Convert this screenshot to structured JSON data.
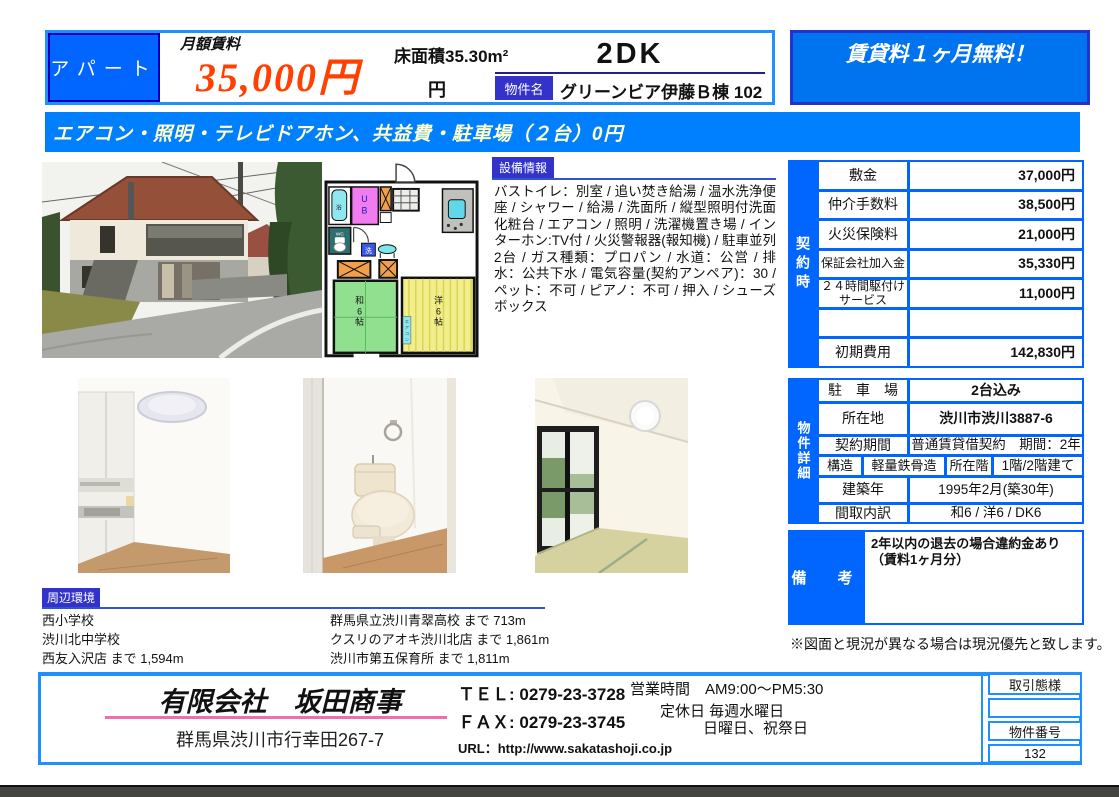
{
  "colors": {
    "primary_blue": "#0080FF",
    "table_blue": "#0066FF",
    "label_indigo": "#3333CC",
    "campaign_blue": "#0073EE",
    "campaign_border": "#2233CC",
    "rent_orange": "#FF4000",
    "banner_text_yellow": "#FFFFCC",
    "pink_underline": "#F06EA9"
  },
  "header": {
    "property_type": "アパート",
    "rent_label": "月額賃料",
    "rent_value": "35,000円",
    "floor_area": "床面積35.30m²",
    "floor_unit": "円",
    "layout": "2DK",
    "property_name_label": "物件名",
    "property_name": "グリーンビア伊藤Ｂ棟 102",
    "campaign": "賃貸料１ヶ月無料！"
  },
  "banner": "エアコン・照明・テレビドアホン、共益費・駐車場（２台）0円",
  "equipment": {
    "label": "設備情報",
    "text": "バストイレ：別室 / 追い焚き給湯 / 温水洗浄便座 / シャワー / 給湯 / 洗面所 / 縦型照明付洗面化粧台 / エアコン / 照明 / 洗濯機置き場 / インターホン:TV付 / 火災警報器(報知機) / 駐車並列2台 / ガス種類：プロパン / 水道：公営 / 排水：公共下水 / 電気容量(契約アンペア)：30 / ペット：不可 / ピアノ：不可 / 押入 / シューズボックス"
  },
  "contract": {
    "label": "契約時",
    "rows": [
      {
        "label": "敷金",
        "value": "37,000円"
      },
      {
        "label": "仲介手数料",
        "value": "38,500円"
      },
      {
        "label": "火災保険料",
        "value": "21,000円"
      },
      {
        "label": "保証会社加入金",
        "value": "35,330円"
      },
      {
        "label": "２４時間駆付けサービス",
        "value": "11,000円"
      },
      {
        "label": "",
        "value": ""
      },
      {
        "label": "初期費用",
        "value": "142,830円"
      }
    ]
  },
  "details": {
    "label": "物件詳細",
    "parking_label": "駐　車　場",
    "parking": "2台込み",
    "location_label": "所在地",
    "location": "渋川市渋川3887-6",
    "period_label": "契約期間",
    "period": "普通賃貸借契約　期間：2年",
    "structure_label": "構造",
    "structure": "軽量鉄骨造",
    "floor_label": "所在階",
    "floor": "1階/2階建て",
    "built_label": "建築年",
    "built": "1995年2月(築30年)",
    "madori_label": "間取内訳",
    "madori": "和6 / 洋6 / DK6"
  },
  "remarks": {
    "label": "備　考",
    "line1": "2年以内の退去の場合違約金あり",
    "line2": "（賃料1ヶ月分）"
  },
  "note": "※図面と現況が異なる場合は現況優先と致します。",
  "environment": {
    "label": "周辺環境",
    "left": [
      "西小学校",
      "渋川北中学校",
      "西友入沢店 まで 1,594m"
    ],
    "right": [
      "群馬県立渋川青翠高校 まで 713m",
      "クスリのアオキ渋川北店 まで 1,861m",
      "渋川市第五保育所 まで 1,811m"
    ]
  },
  "footer": {
    "company": "有限会社　坂田商事",
    "address": "群馬県渋川市行幸田267-7",
    "tel": "ＴＥＬ: 0279-23-3728",
    "fax": "ＦＡＸ: 0279-23-3745",
    "url": "URL：http://www.sakatashoji.co.jp",
    "hours": "営業時間　AM9:00～PM5:30",
    "holiday1": "定休日 毎週水曜日",
    "holiday2": "日曜日、祝祭日",
    "deal_type_label": "取引態様",
    "property_no_label": "物件番号",
    "property_no": "132"
  },
  "floorplan": {
    "bath": "浴",
    "ub_u": "U",
    "ub_b": "B",
    "wc": "WC",
    "wash": "洗",
    "japanese_room": [
      "和",
      "6",
      "帖"
    ],
    "western_room": [
      "洋",
      "6",
      "帖"
    ],
    "aircon": [
      "エ",
      "ア",
      "コ",
      "ン"
    ]
  }
}
